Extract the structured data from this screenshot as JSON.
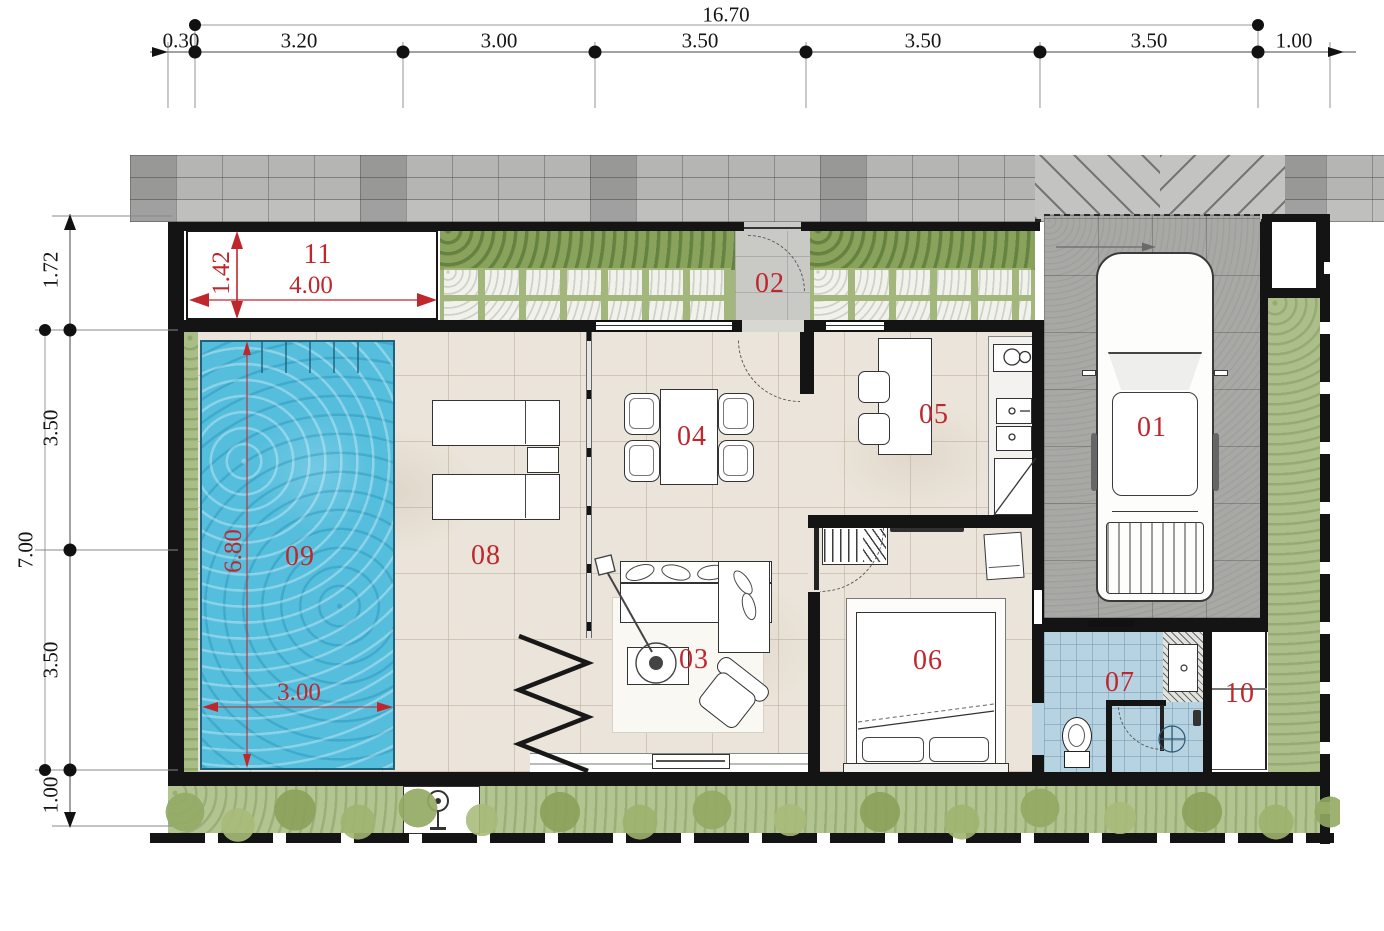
{
  "dimensions": {
    "top": {
      "total": "16.70",
      "segments": [
        "0.30",
        "3.20",
        "3.00",
        "3.50",
        "3.50",
        "3.50",
        "1.00"
      ]
    },
    "left": {
      "total": "7.00",
      "segments": [
        "1.72",
        "3.50",
        "3.50",
        "1.00"
      ]
    }
  },
  "feature_dimensions": {
    "area11_depth": "1.42",
    "area11_width": "4.00",
    "pool_length": "6.80",
    "pool_width": "3.00"
  },
  "room_labels": {
    "r01": "01",
    "r02": "02",
    "r03": "03",
    "r04": "04",
    "r05": "05",
    "r06": "06",
    "r07": "07",
    "r08": "08",
    "r09": "09",
    "r10": "10",
    "r11": "11"
  },
  "colors": {
    "label_red": "#c0272d",
    "wall_black": "#141414",
    "pool_water": "#55bedd",
    "floor_tile": "#eae4da",
    "road_paving": "#b5b5b3",
    "carport_paving": "#a8a9a5",
    "garden_green": "#aec08c",
    "bathroom_tile": "#b7d3e2"
  }
}
